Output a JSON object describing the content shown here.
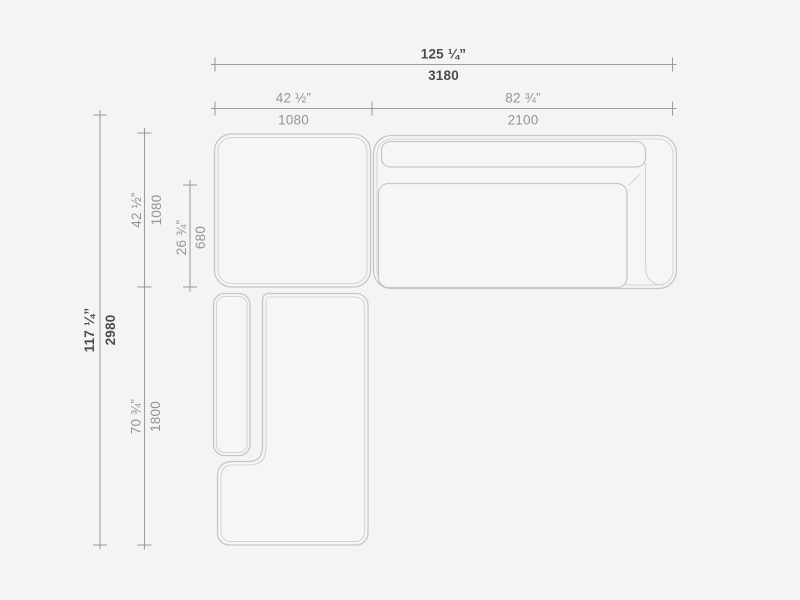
{
  "colors": {
    "background": "#f4f4f4",
    "surface": "#f6f6f6",
    "outline": "#c6c6c6",
    "outline_inner": "#d4d4d4",
    "dimension_line": "#9c9c9c",
    "label_primary": "#4c4c4c",
    "label_secondary": "#959595"
  },
  "dims": {
    "overall_width": {
      "imperial": "125 ¼”",
      "metric": "3180"
    },
    "upper_left_width": {
      "imperial": "42 ½”",
      "metric": "1080"
    },
    "upper_right_width": {
      "imperial": "82 ¾”",
      "metric": "2100"
    },
    "overall_depth": {
      "imperial": "117 ¼”",
      "metric": "2980"
    },
    "upper_depth": {
      "imperial": "42 ½”",
      "metric": "1080"
    },
    "seat_depth": {
      "imperial": "26 ¾”",
      "metric": "680"
    },
    "chaise_depth": {
      "imperial": "70 ¾”",
      "metric": "1800"
    }
  }
}
